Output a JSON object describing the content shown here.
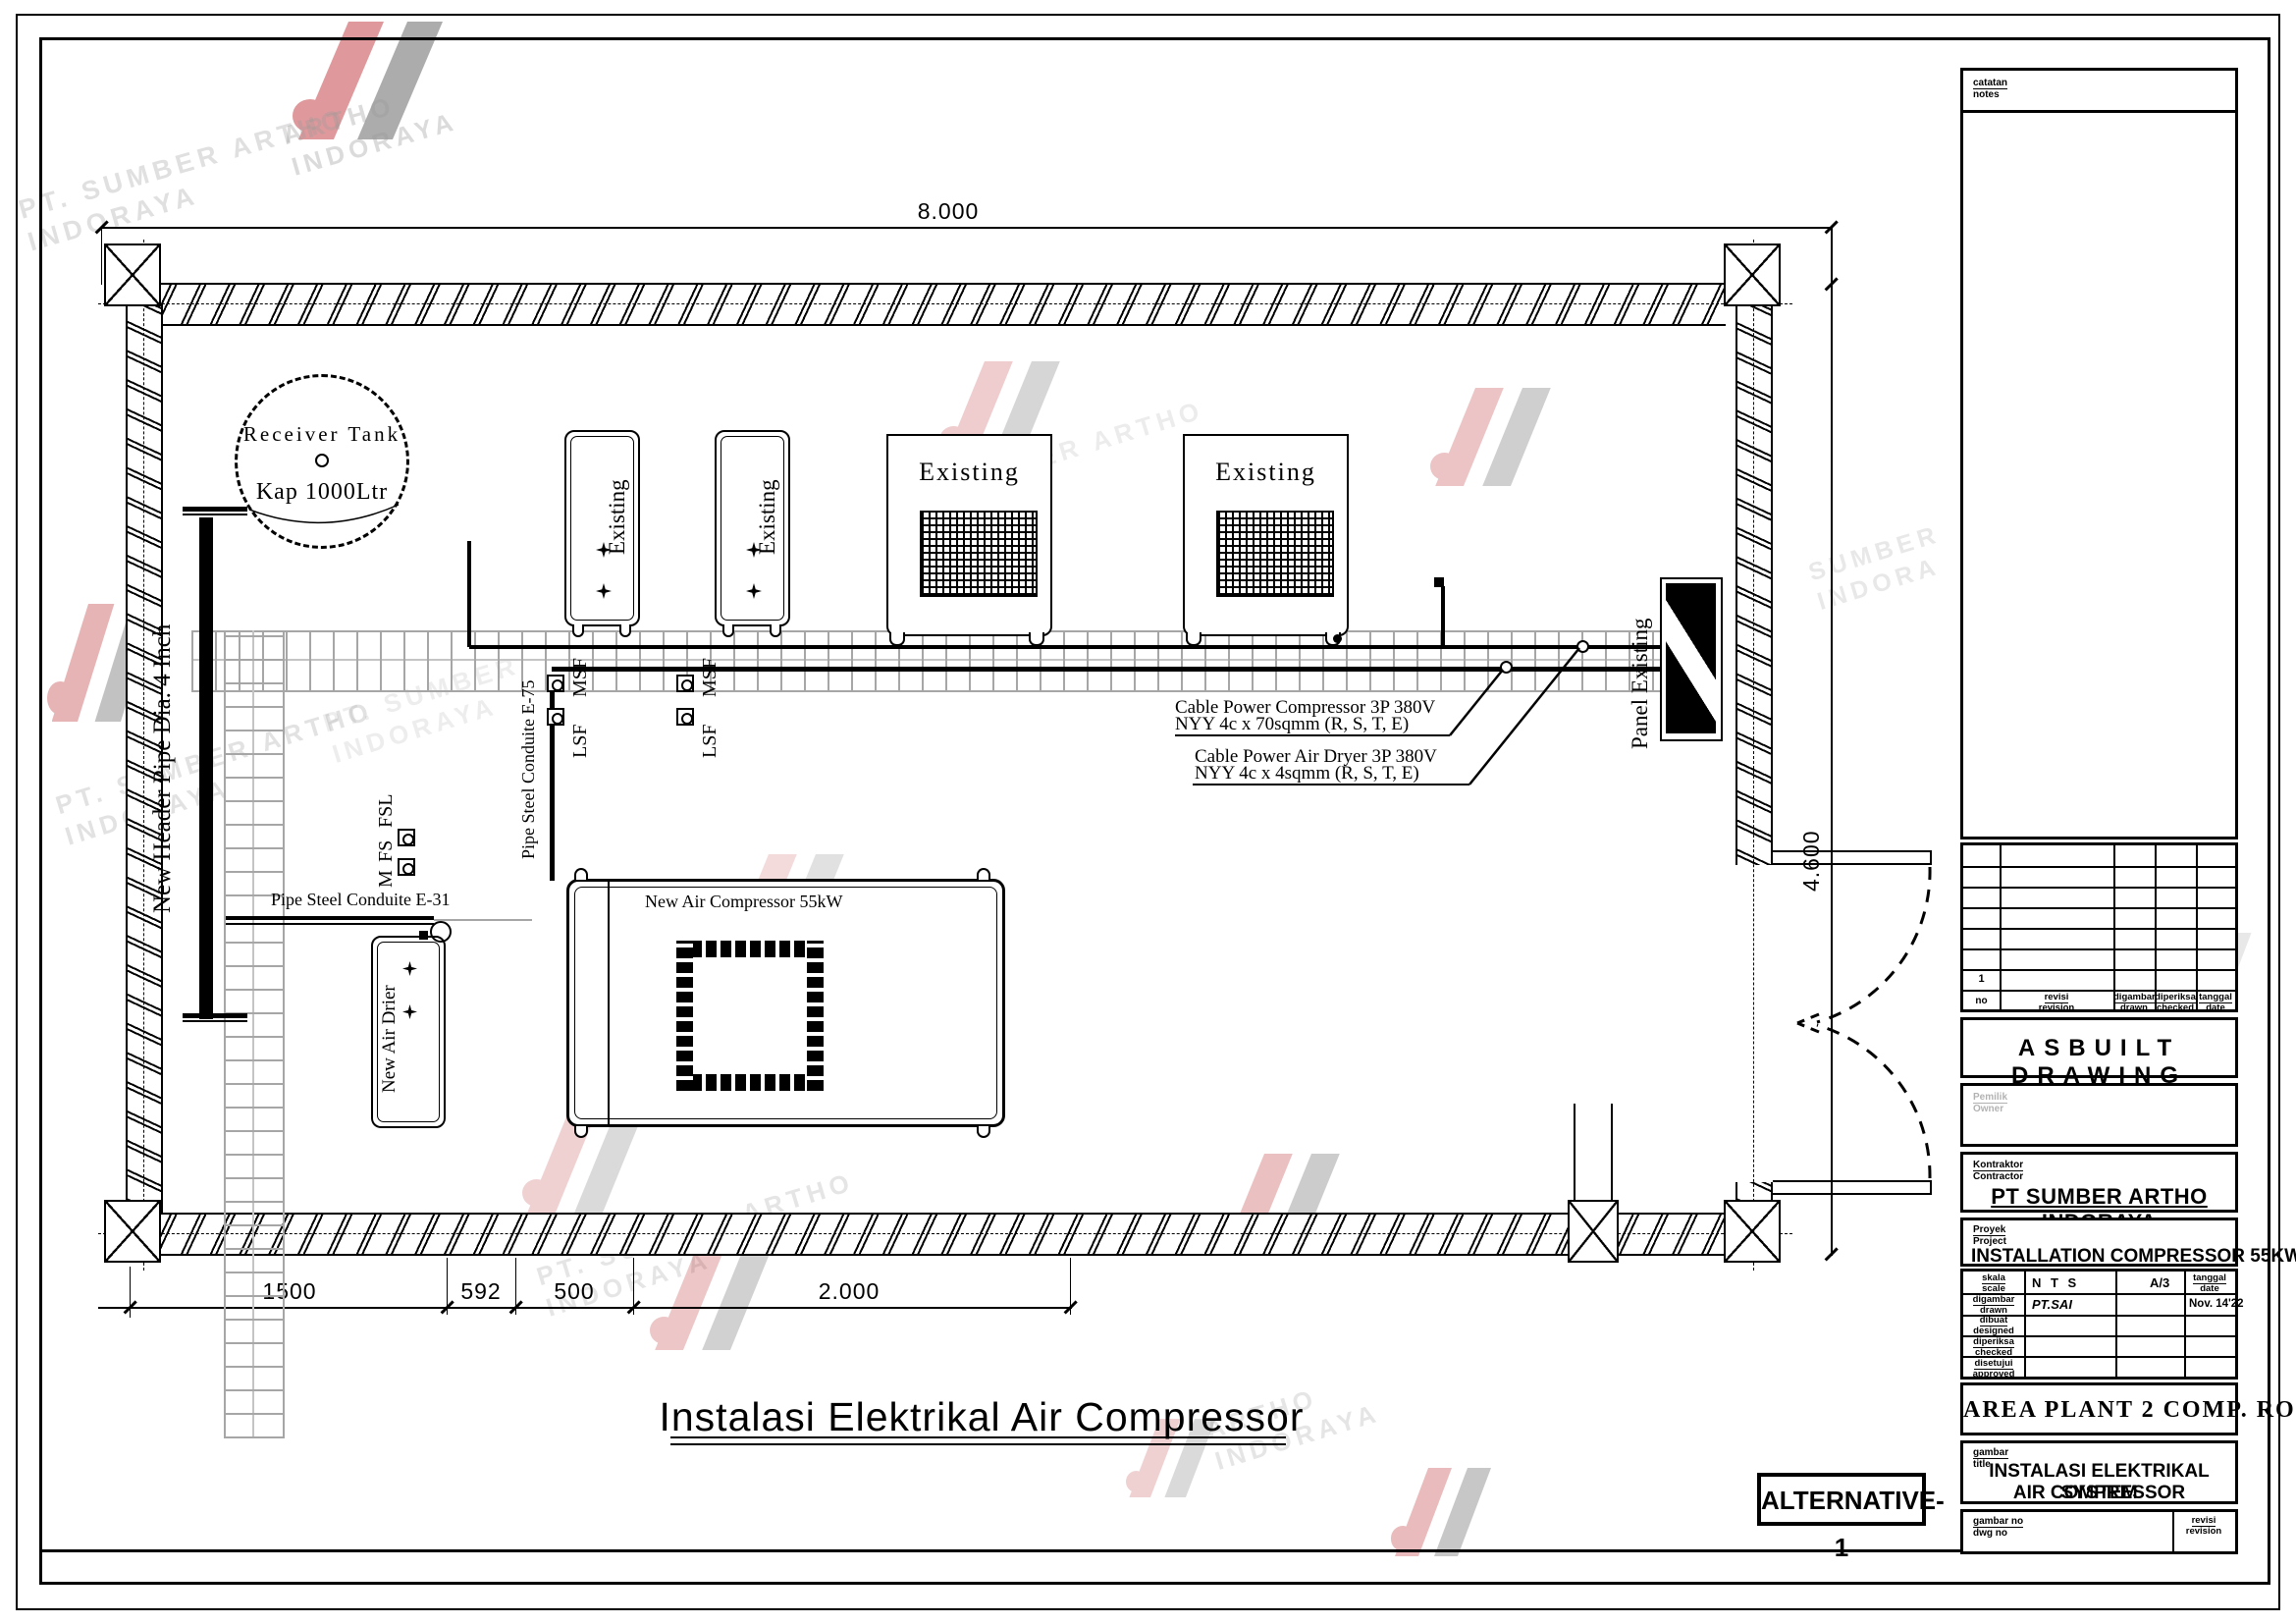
{
  "page": {
    "background": "#ffffff",
    "line_color": "#000000",
    "tray_color": "#a6a6a6"
  },
  "watermark": {
    "company_line1": "PT. SUMBER ARTHO",
    "company_line2": "INDORAYA",
    "logo_red": "#b92025",
    "logo_dark": "#4a4a4a"
  },
  "drawing": {
    "title": "Instalasi Elektrikal Air Compressor",
    "alternative": "ALTERNATIVE-1",
    "dim_top": "8.000",
    "dim_right": "4.600",
    "dim_bottom": [
      "1500",
      "592",
      "500",
      "2.000"
    ],
    "tank_line1": "Receiver Tank",
    "tank_line2": "Kap 1000Ltr",
    "header_pipe": "New Header Pipe Dia. 4 Inch",
    "conduit_e75": "Pipe Steel Conduite E-75",
    "conduit_e31": "Pipe Steel Conduite E-31",
    "panel": "Panel Existing",
    "compressor": "New Air Compressor 55kW",
    "dryer": "New Air Drier",
    "existing": "Existing",
    "msf": "MSF",
    "lsf": "LSF",
    "fsl": "FSL",
    "fs": "FS",
    "m": "M",
    "cable_compressor_1": "Cable Power Compressor 3P 380V",
    "cable_compressor_2": "NYY 4c x 70sqmm (R, S, T, E)",
    "cable_dryer_1": "Cable Power Air Dryer 3P 380V",
    "cable_dryer_2": "NYY 4c x 4sqmm (R, S, T, E)"
  },
  "titleblock": {
    "notes": {
      "id": "catatan",
      "en": "notes"
    },
    "rev": {
      "no": "no",
      "row1_no": "1",
      "rev_id": "revisi",
      "rev_en": "revision",
      "drawn_id": "digambar",
      "drawn_en": "drawn",
      "checked_id": "diperiksa",
      "checked_en": "checked",
      "date_id": "tanggal",
      "date_en": "date"
    },
    "asbuilt": "ASBUILT DRAWING",
    "owner": {
      "id": "Pemilik",
      "en": "Owner"
    },
    "contractor": {
      "id": "Kontraktor",
      "en": "Contractor",
      "name": "PT SUMBER ARTHO INDORAYA"
    },
    "project": {
      "id": "Proyek",
      "en": "Project",
      "name": "INSTALLATION COMPRESSOR 55KW"
    },
    "approval": {
      "scale_id": "skala",
      "scale_en": "scale",
      "scale_val": "N T S",
      "paper": "A/3",
      "date_id": "tanggal",
      "date_en": "date",
      "drawn_id": "digambar",
      "drawn_en": "drawn",
      "drawn_val": "PT.SAI",
      "drawn_date": "Nov. 14'22",
      "designed_id": "dibuat",
      "designed_en": "designed",
      "checked_id": "diperiksa",
      "checked_en": "checked",
      "approved_id": "disetujui",
      "approved_en": "approved"
    },
    "area": "AREA PLANT 2 COMP. ROOM",
    "sheet": {
      "id": "gambar",
      "en": "title",
      "line1": "INSTALASI ELEKTRIKAL SYSTEM",
      "line2": "AIR COMPRESSOR"
    },
    "dwgno": {
      "id": "gambar no",
      "en": "dwg no",
      "rev_id": "revisi",
      "rev_en": "revision"
    }
  }
}
